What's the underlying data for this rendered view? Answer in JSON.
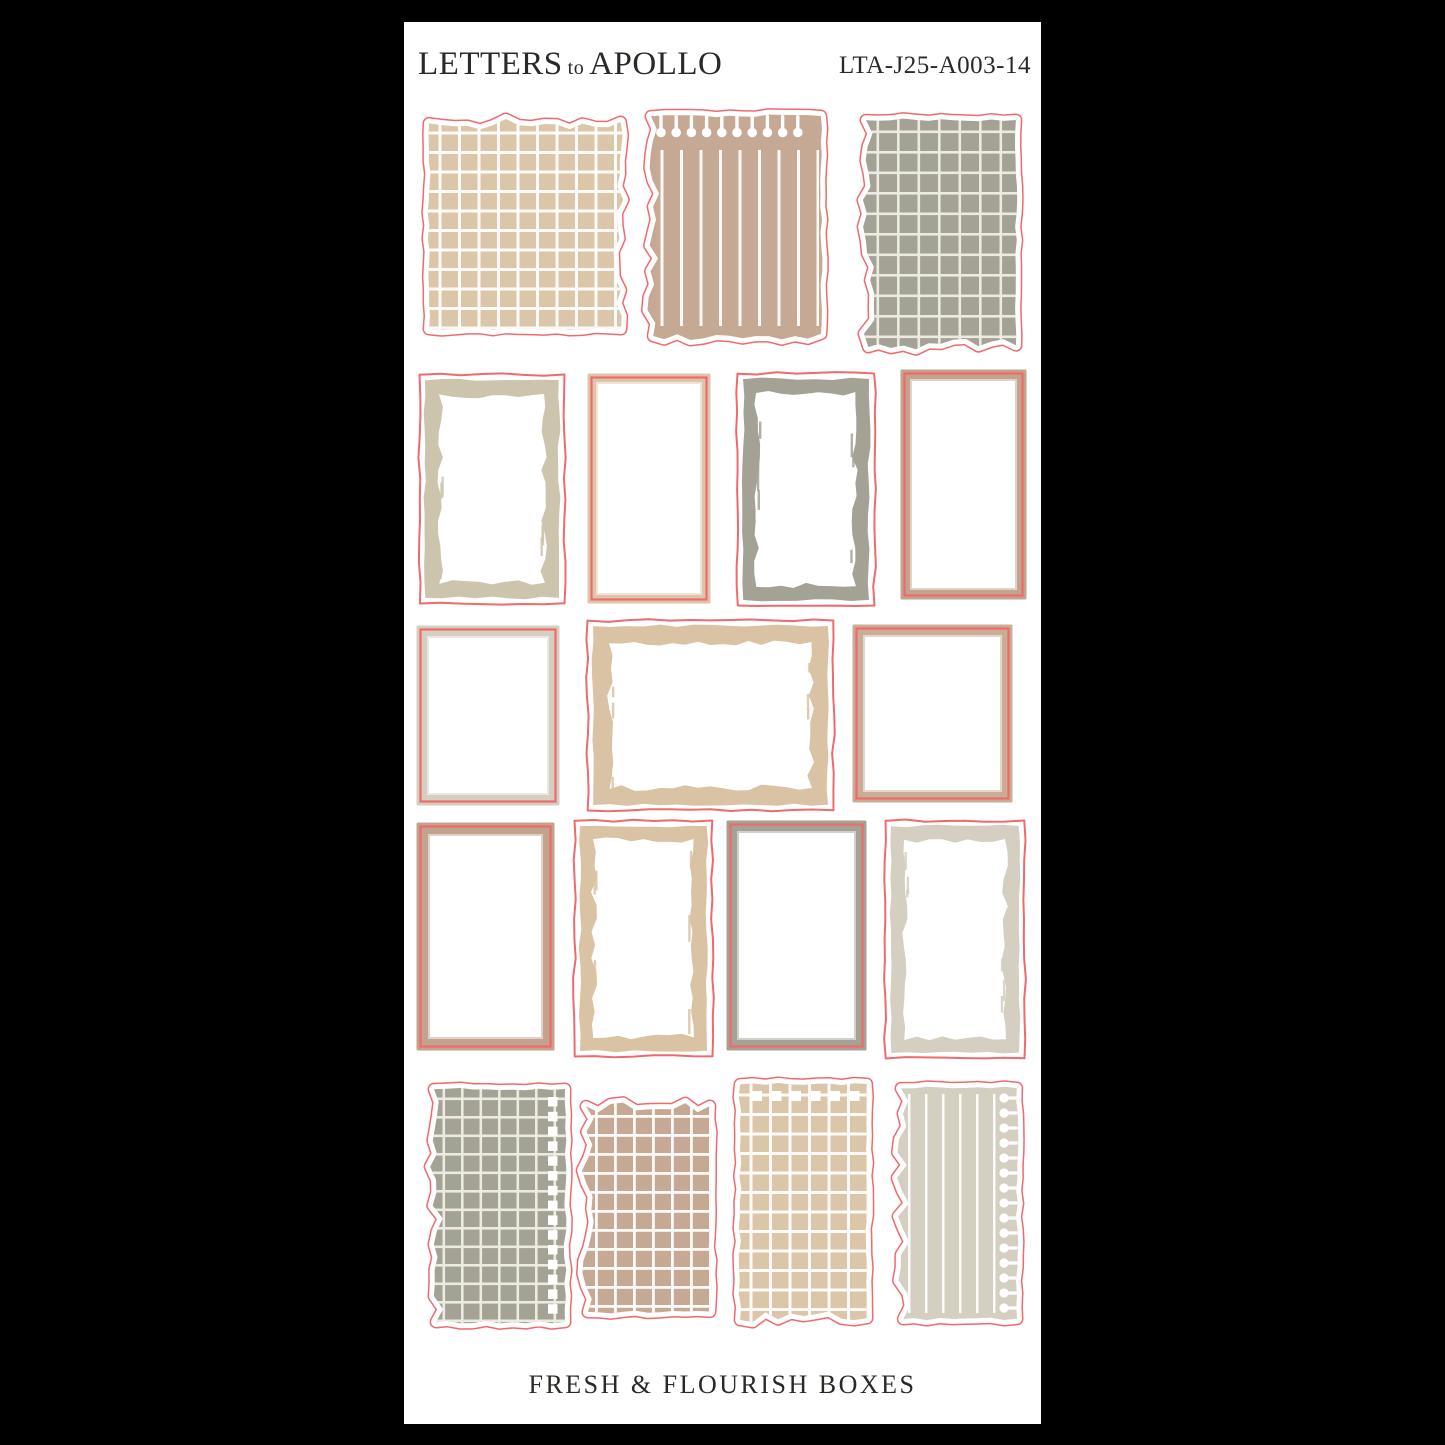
{
  "header": {
    "brand_first": "LETTERS",
    "brand_to": "to",
    "brand_last": "APOLLO",
    "sku": "LTA-J25-A003-14"
  },
  "footer": {
    "title": "FRESH & FLOURISH BOXES"
  },
  "colors": {
    "bg": "#000000",
    "sheet": "#ffffff",
    "ink": "#2b2926",
    "red": "#f0696c",
    "tan": "#dcc6aa",
    "tanbrush": "#d9c3a4",
    "mauve": "#c6a994",
    "mauve2": "#c2a38d",
    "sage": "#a3a295",
    "sand": "#cdc4ae",
    "greige": "#d5cfc1",
    "rosewood": "#c9ad97",
    "gridline": "#fdfbf7",
    "gridlineSoft": "#ecebe1"
  },
  "stickers": [
    {
      "name": "sticker-torn-grid-tan",
      "kind": "torn",
      "color": "tan",
      "x": 15,
      "y": 90,
      "w": 212,
      "h": 227,
      "torn": [
        "top",
        "right"
      ],
      "pattern": "grid",
      "cell": 19.5,
      "line": 3,
      "lineColor": "gridline",
      "seed": 11
    },
    {
      "name": "sticker-torn-stripe-mauve-keyholes",
      "kind": "torn",
      "color": "mauve",
      "x": 237,
      "y": 84,
      "w": 190,
      "h": 240,
      "torn": [
        "left",
        "bottom"
      ],
      "pattern": "stripes",
      "cell": 19.5,
      "line": 3,
      "lineColor": "gridline",
      "patInset": [
        44,
        12,
        20,
        12
      ],
      "perf": "keyholes-top",
      "seed": 22
    },
    {
      "name": "sticker-torn-grid-sage",
      "kind": "torn",
      "color": "sage",
      "x": 452,
      "y": 88,
      "w": 170,
      "h": 247,
      "torn": [
        "left",
        "bottom"
      ],
      "pattern": "grid",
      "cell": 20.5,
      "line": 2.6,
      "lineColor": "gridlineSoft",
      "seed": 33
    },
    {
      "name": "sticker-brush-frame-sand",
      "kind": "brush",
      "color": "sand",
      "x": 13,
      "y": 350,
      "w": 150,
      "h": 234,
      "t": 14,
      "seed": 44
    },
    {
      "name": "sticker-inset-frame-tan",
      "kind": "inset",
      "color": "tan",
      "x": 183,
      "y": 351,
      "w": 124,
      "h": 231,
      "t": 11,
      "seed": 55
    },
    {
      "name": "sticker-brush-frame-sage",
      "kind": "brush",
      "color": "sage",
      "x": 331,
      "y": 349,
      "w": 142,
      "h": 237,
      "t": 13,
      "seed": 66
    },
    {
      "name": "sticker-inset-frame-mauve",
      "kind": "inset",
      "color": "mauve2",
      "x": 496,
      "y": 347,
      "w": 127,
      "h": 231,
      "t": 12,
      "seed": 77
    },
    {
      "name": "sticker-inset-frame-greige-square",
      "kind": "inset",
      "color": "greige",
      "x": 12,
      "y": 603,
      "w": 144,
      "h": 181,
      "t": 13,
      "seed": 88
    },
    {
      "name": "sticker-brush-frame-tan-square",
      "kind": "brush",
      "color": "tanbrush",
      "x": 181,
      "y": 596,
      "w": 251,
      "h": 195,
      "t": 16,
      "seed": 99
    },
    {
      "name": "sticker-inset-frame-rosewood-square",
      "kind": "inset",
      "color": "rosewood",
      "x": 448,
      "y": 602,
      "w": 161,
      "h": 179,
      "t": 13,
      "seed": 110
    },
    {
      "name": "sticker-inset-frame-mauve-tall",
      "kind": "inset",
      "color": "mauve2",
      "x": 12,
      "y": 800,
      "w": 139,
      "h": 229,
      "t": 14,
      "seed": 121
    },
    {
      "name": "sticker-brush-frame-tan-tall",
      "kind": "brush",
      "color": "tanbrush",
      "x": 168,
      "y": 796,
      "w": 143,
      "h": 241,
      "t": 13,
      "seed": 132
    },
    {
      "name": "sticker-inset-frame-sage-tall",
      "kind": "inset",
      "color": "sage",
      "x": 322,
      "y": 798,
      "w": 141,
      "h": 231,
      "t": 13,
      "seed": 143
    },
    {
      "name": "sticker-brush-frame-greige-tall",
      "kind": "brush",
      "color": "greige",
      "x": 479,
      "y": 796,
      "w": 144,
      "h": 243,
      "t": 13,
      "seed": 154
    },
    {
      "name": "sticker-torn-grid-sage-squares",
      "kind": "torn",
      "color": "sage",
      "x": 20,
      "y": 1057,
      "w": 151,
      "h": 253,
      "torn": [
        "left"
      ],
      "pattern": "grid",
      "cell": 18.5,
      "line": 2.6,
      "lineColor": "gridlineSoft",
      "perf": "squares-right",
      "seed": 165
    },
    {
      "name": "sticker-torn-grid-mauve",
      "kind": "torn",
      "color": "mauve",
      "x": 172,
      "y": 1074,
      "w": 144,
      "h": 226,
      "torn": [
        "left",
        "top"
      ],
      "pattern": "grid",
      "cell": 19,
      "line": 2.8,
      "lineColor": "gridline",
      "seed": 176
    },
    {
      "name": "sticker-torn-grid-tan-squares",
      "kind": "torn",
      "color": "tan",
      "x": 326,
      "y": 1052,
      "w": 147,
      "h": 256,
      "torn": [
        "bottom"
      ],
      "pattern": "grid",
      "cell": 19.5,
      "line": 3,
      "lineColor": "gridline",
      "perf": "squares-top",
      "seed": 187
    },
    {
      "name": "sticker-torn-line-greige-keyholes",
      "kind": "torn",
      "color": "greige",
      "x": 487,
      "y": 1056,
      "w": 136,
      "h": 251,
      "torn": [
        "left"
      ],
      "pattern": "stripes",
      "cell": 17,
      "line": 2.5,
      "lineColor": "gridline",
      "patInset": [
        16,
        30,
        16,
        14
      ],
      "perf": "keyholes-right",
      "seed": 198
    }
  ]
}
